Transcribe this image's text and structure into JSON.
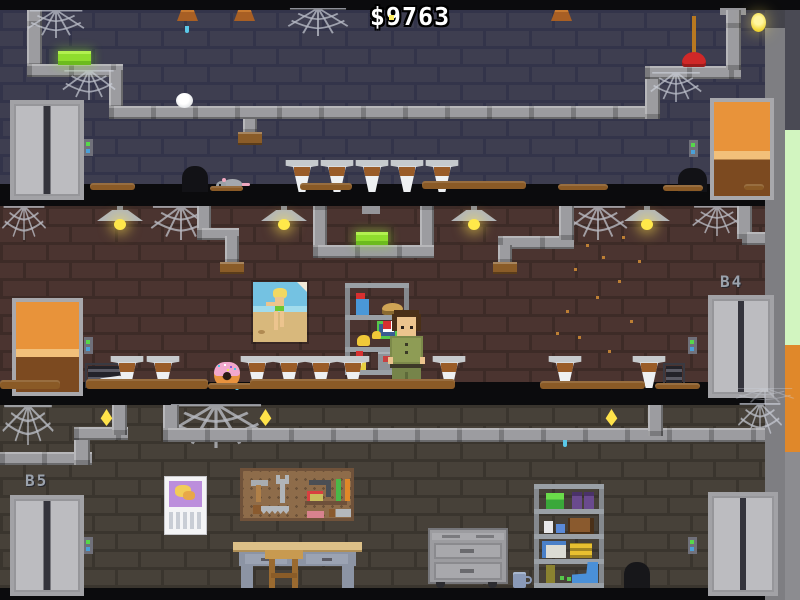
{
  "hud": {
    "money": "$9763"
  },
  "labels": {
    "floor_b4": "B4",
    "floor_b5": "B5"
  },
  "palette": {
    "top_wall": "#3e3e50",
    "mid_wall": "#4b3430",
    "bottom_wall": "#474139",
    "pipe_gray": "#9c9ca0",
    "elevator_gray": "#bcbcc0",
    "door_orange": "#e8933a",
    "glow_bar_green": "#8fdd2e",
    "lamp_yellow": "#ffe84a",
    "call_button_green": "#56d84a",
    "call_button_blue": "#4aa0d8",
    "shaft_pale_green": "#d2f5c0",
    "shaft_orange": "#e0882a",
    "plunger_red": "#d02828",
    "character_shirt_green": "#8e9c55",
    "urinal_white": "#eef0f2",
    "dirt_brown": "#8a5a26"
  }
}
